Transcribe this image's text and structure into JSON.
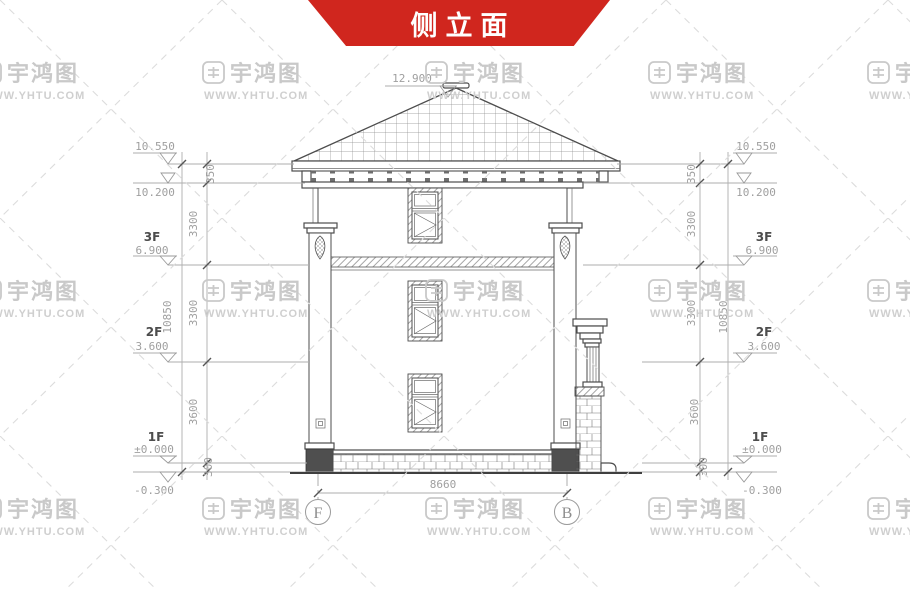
{
  "title": "侧立面",
  "watermark": {
    "brand": "宇鸿图",
    "url": "WWW.YHTU.COM"
  },
  "colors": {
    "banner_red": "#d0261e",
    "drawing_line": "#4d4d4d",
    "dimension_gray": "#9f9f9f",
    "watermark_gray": "#c9c9c9"
  },
  "axes": {
    "left": "F",
    "right": "B"
  },
  "levels": {
    "ridge": "12.900",
    "eave": "10.550",
    "cornice": "10.200",
    "f3": "6.900",
    "f2": "3.600",
    "f1": "±0.000",
    "ground": "-0.300"
  },
  "floors": {
    "f3": "3F",
    "f2": "2F",
    "f1": "1F"
  },
  "vdims": {
    "parapet": "350",
    "story_upper": "3300",
    "story_mid": "3300",
    "story_lower": "3600",
    "plinth": "300",
    "total": "10850"
  },
  "hdims": {
    "span": "8660"
  }
}
